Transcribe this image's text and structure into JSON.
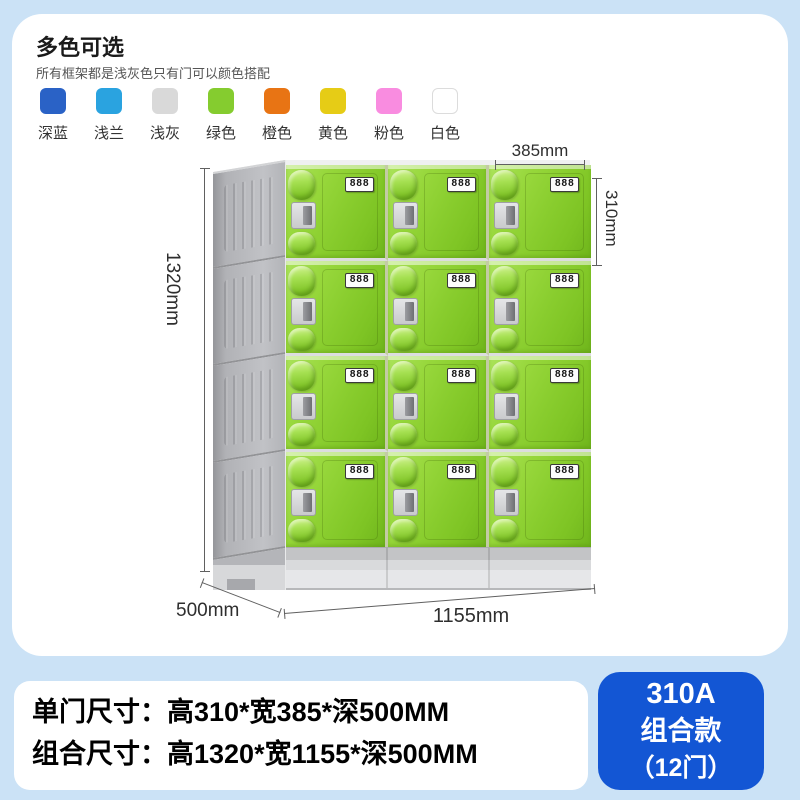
{
  "color_section": {
    "title": "多色可选",
    "subtitle": "所有框架都是浅灰色只有门可以颜色搭配",
    "swatches": [
      {
        "label": "深蓝",
        "color": "#2a62c6"
      },
      {
        "label": "浅兰",
        "color": "#2aa3e0"
      },
      {
        "label": "浅灰",
        "color": "#d9d9d9"
      },
      {
        "label": "绿色",
        "color": "#85cc2f"
      },
      {
        "label": "橙色",
        "color": "#e87414"
      },
      {
        "label": "黄色",
        "color": "#e6cc16"
      },
      {
        "label": "粉色",
        "color": "#f98ce0"
      },
      {
        "label": "白色",
        "color": "#ffffff"
      }
    ]
  },
  "locker": {
    "rows": 4,
    "columns": 3,
    "lock_display": "888",
    "door_color": "#8ed231",
    "frame_color": "#b2b3b7"
  },
  "dimensions": {
    "door_width": "385mm",
    "door_height": "310mm",
    "total_height": "1320mm",
    "depth": "500mm",
    "total_width": "1155mm"
  },
  "specs": {
    "line1": "单门尺寸：高310*宽385*深500MM",
    "line2": "组合尺寸：高1320*宽1155*深500MM"
  },
  "badge": {
    "model": "310A",
    "type": "组合款",
    "doors": "（12门）",
    "bg_color": "#1356d4"
  }
}
